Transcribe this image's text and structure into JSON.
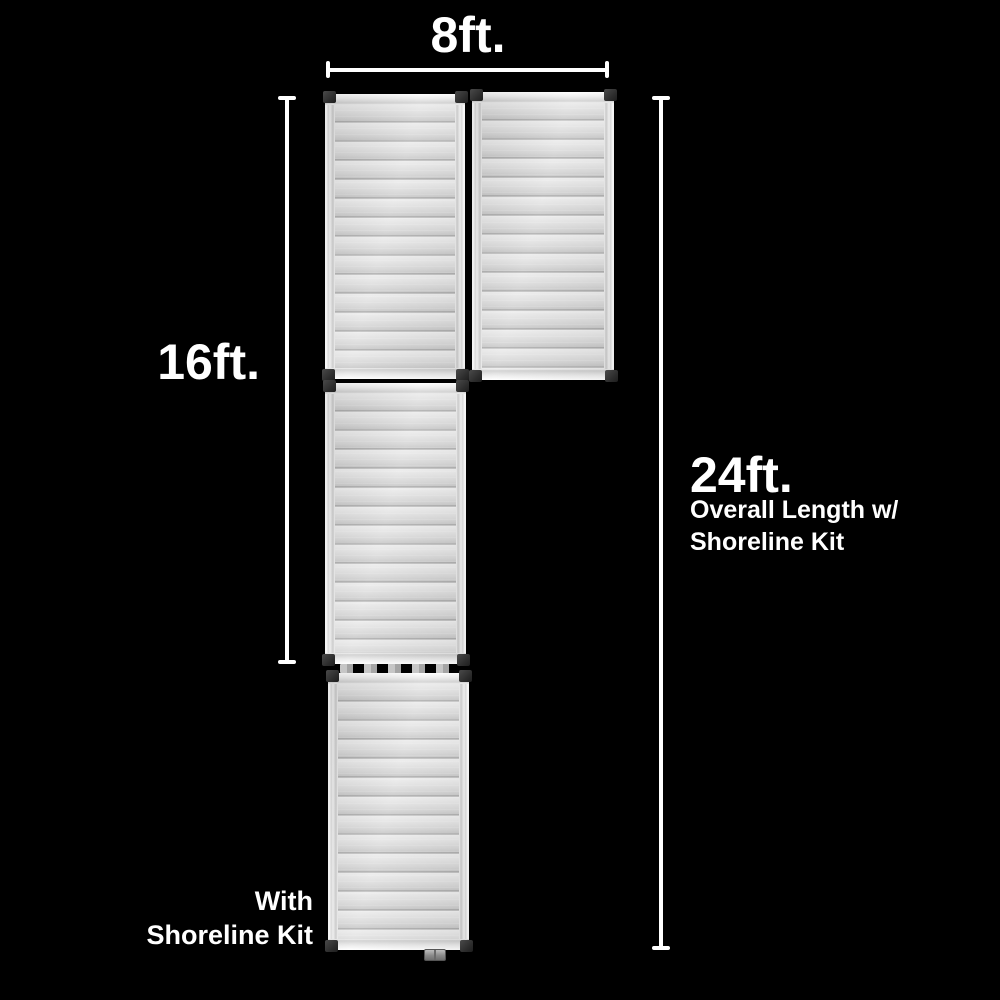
{
  "labels": {
    "width": "8ft.",
    "ramp_length": "16ft.",
    "overall": "24ft.",
    "overall_sub1": "Overall Length w/",
    "overall_sub2": "Shoreline Kit",
    "caption_line1": "With",
    "caption_line2": "Shoreline Kit"
  },
  "measurements": {
    "width_ft": 8,
    "ramp_length_ft": 16,
    "overall_length_ft": 24
  },
  "sections": [
    "top-left-ramp-panel",
    "top-right-ramp-panel",
    "middle-ramp-panel",
    "bottom-shoreline-panel"
  ],
  "colors": {
    "background": "#000000",
    "text": "#ffffff",
    "dimension_line": "#ffffff",
    "panel_light": "#f5f5f5",
    "panel_mid": "#d7d7d7",
    "panel_shadow": "#9c9c9c",
    "corner_cap": "#2e2e2e"
  }
}
